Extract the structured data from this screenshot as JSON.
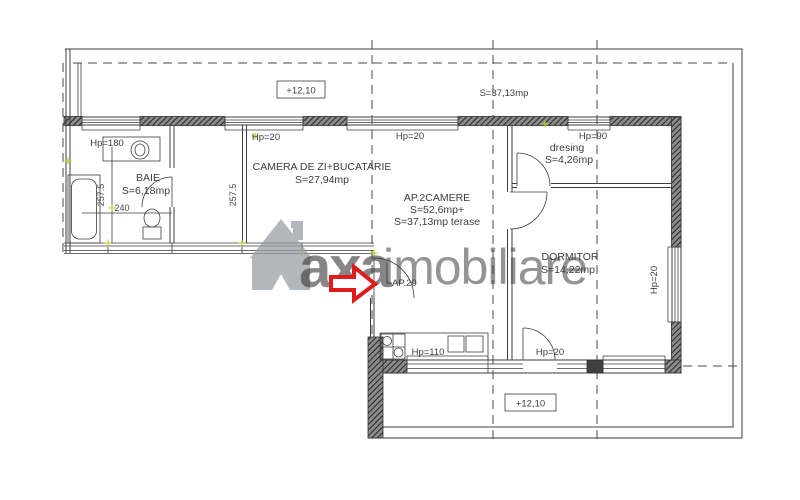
{
  "levels": {
    "top": "+12,10",
    "bottom": "+12,10"
  },
  "terrace": {
    "area": "S=37,13mp"
  },
  "apartment": {
    "label": "AP.2CAMERE",
    "area_line1": "S=52,6mp+",
    "area_line2": "S=37,13mp terase",
    "entrance_label": "AP.20"
  },
  "rooms": {
    "living": {
      "name": "CAMERA DE ZI+BUCATARIE",
      "area": "S=27,94mp"
    },
    "bath": {
      "name": "BAIE",
      "area": "S=6,18mp"
    },
    "bedroom": {
      "name": "DORMITOR",
      "area": "S=14,22mp"
    },
    "dressing": {
      "name": "dresing",
      "area": "S=4,26mp"
    }
  },
  "windows": {
    "bath": "Hp=180",
    "living_a": "Hp=20",
    "living_b": "Hp=20",
    "dressing": "Hp=90",
    "kitchen": "Hp=110",
    "bedroom_south": "Hp=20",
    "bedroom_east": "Hp=20"
  },
  "dimensions": {
    "room_height": "257.5",
    "bath_width": "240"
  },
  "watermark": {
    "brand_gray": "axa",
    "brand_red": "imobiliare"
  },
  "colors": {
    "line": "#3d3d3d",
    "arrow_red": "#dd1c1c",
    "watermark_gray": "#939ca4",
    "watermark_red": "#e79a9a",
    "marker_yellow": "#c9cc3b"
  }
}
